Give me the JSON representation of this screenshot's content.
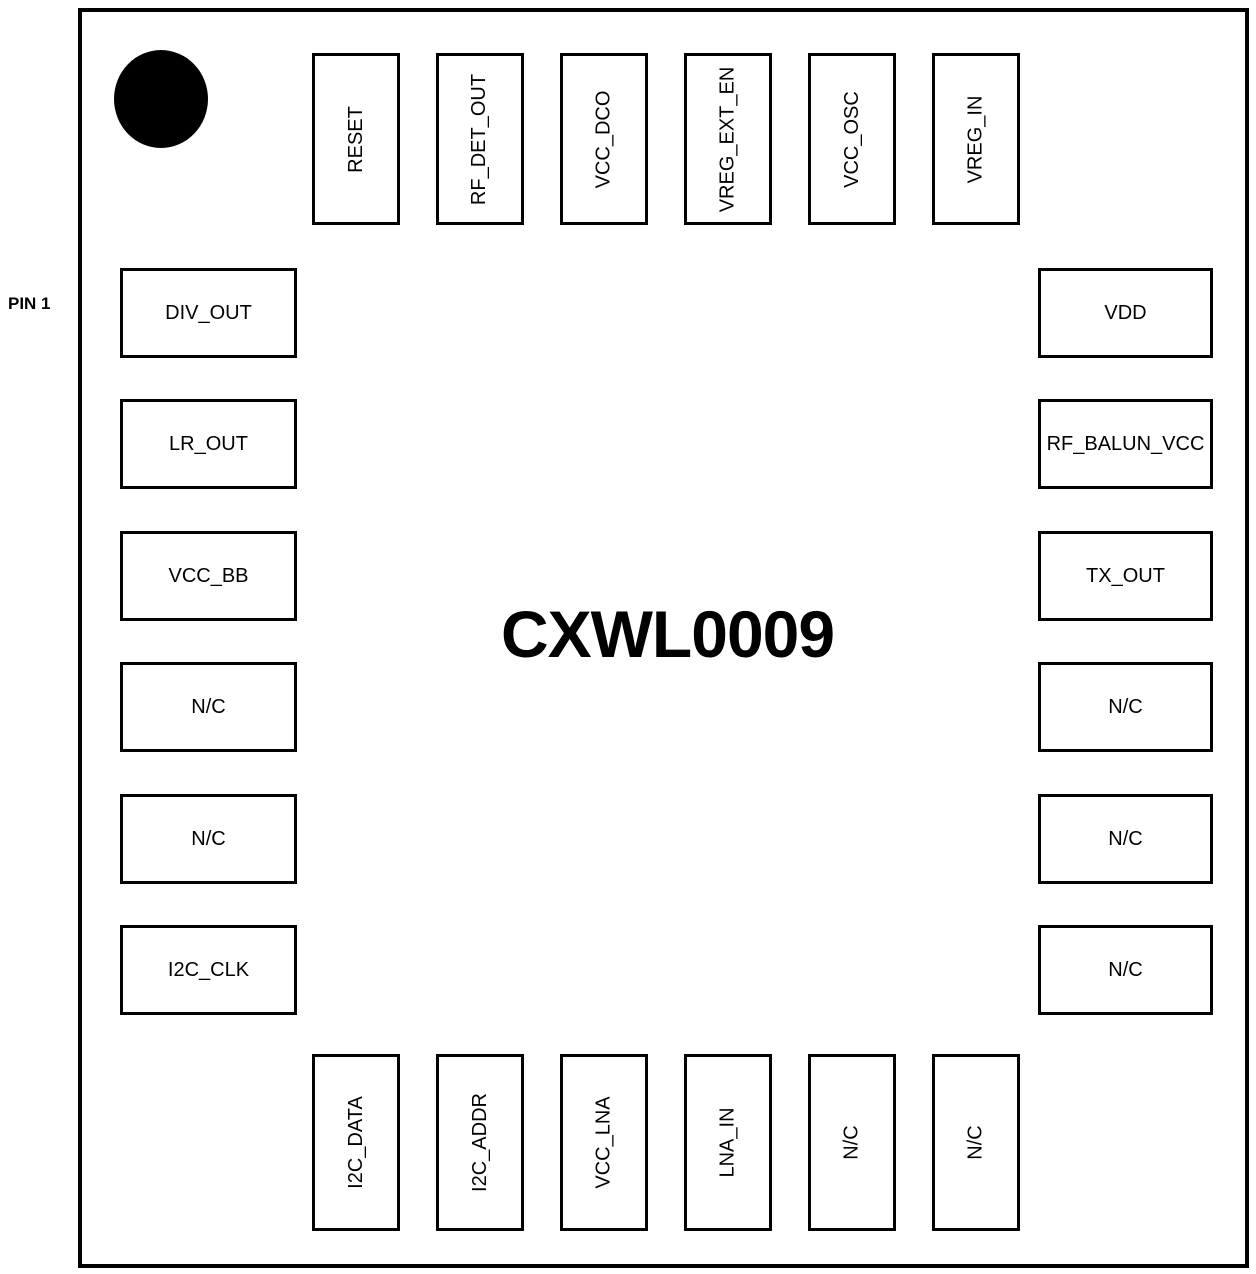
{
  "chip": {
    "title": "CXWL0009"
  },
  "labels": {
    "pin1": "PIN 1"
  },
  "pins": {
    "top": [
      "RESET",
      "RF_DET_OUT",
      "VCC_DCO",
      "VREG_EXT_EN",
      "VCC_OSC",
      "VREG_IN"
    ],
    "left": [
      "DIV_OUT",
      "LR_OUT",
      "VCC_BB",
      "N/C",
      "N/C",
      "I2C_CLK"
    ],
    "right": [
      "VDD",
      "RF_BALUN_VCC",
      "TX_OUT",
      "N/C",
      "N/C",
      "N/C"
    ],
    "bottom": [
      "I2C_DATA",
      "I2C_ADDR",
      "VCC_LNA",
      "LNA_IN",
      "N/C",
      "N/C"
    ]
  },
  "colors": {
    "ink": "#000000",
    "background": "#ffffff"
  }
}
